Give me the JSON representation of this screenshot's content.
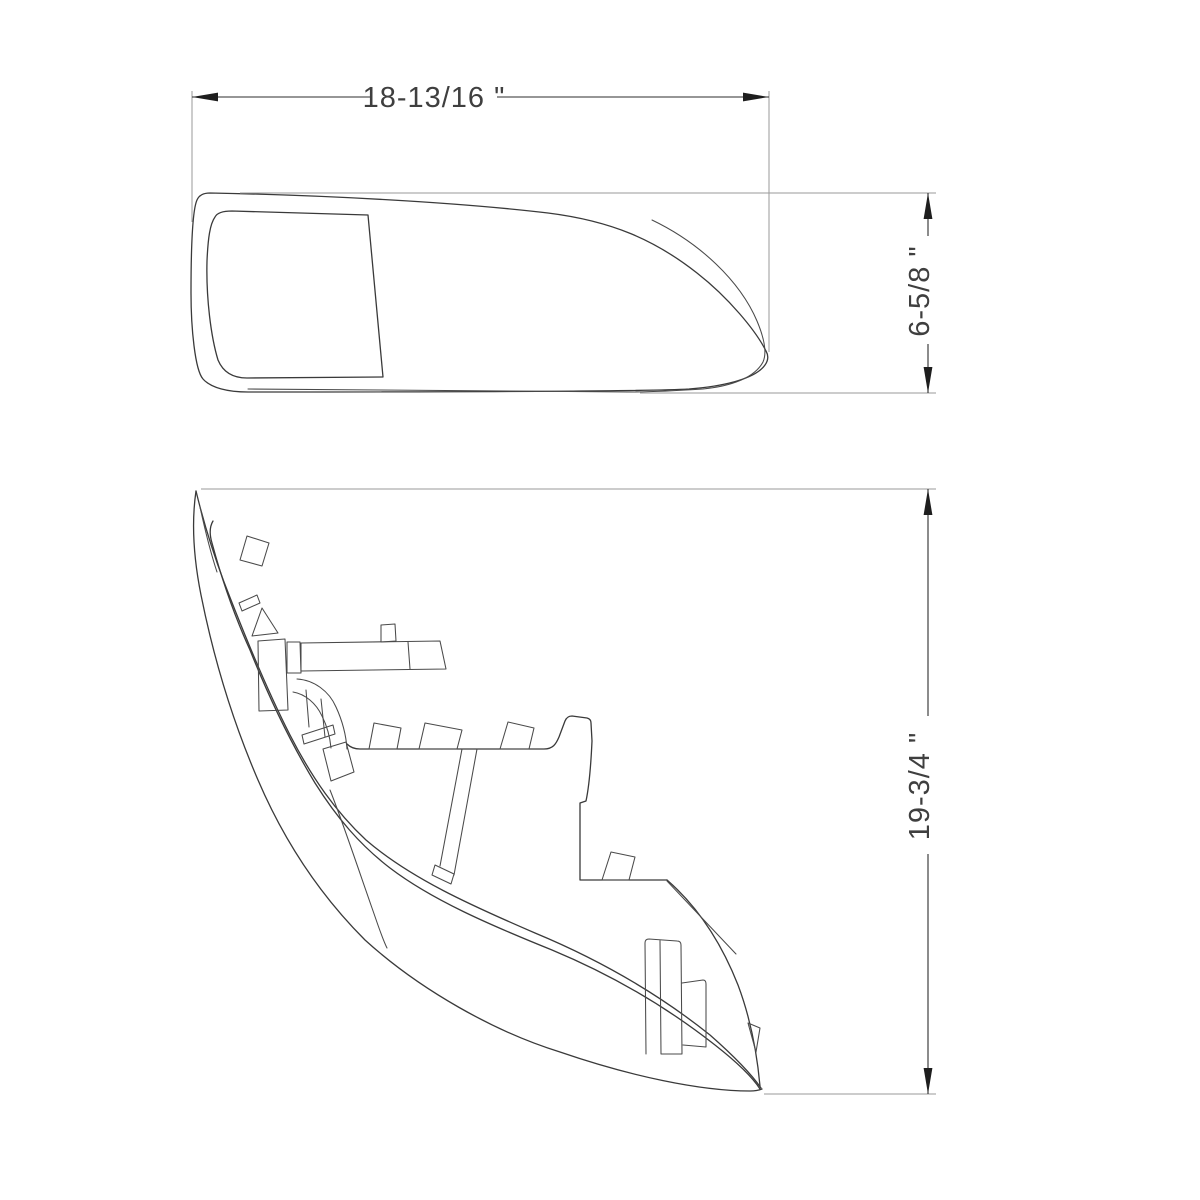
{
  "drawing": {
    "type": "technical dimension drawing",
    "part": "headlight lens and housing profiles",
    "dimensions": {
      "width_label": "18-13/16 \"",
      "height_label": "6-5/8 \"",
      "length_label": "19-3/4 \""
    },
    "colors": {
      "background": "#ffffff",
      "part_line": "#3a3a3a",
      "dimension_line": "#2e2e2e",
      "extension_line": "#9a9a9a",
      "text": "#3f3f3f"
    },
    "views": [
      {
        "id": "top-view",
        "description": "lens outline viewed from above with inner window"
      },
      {
        "id": "side-view",
        "description": "housing profile with mounting tabs and posts"
      }
    ]
  }
}
